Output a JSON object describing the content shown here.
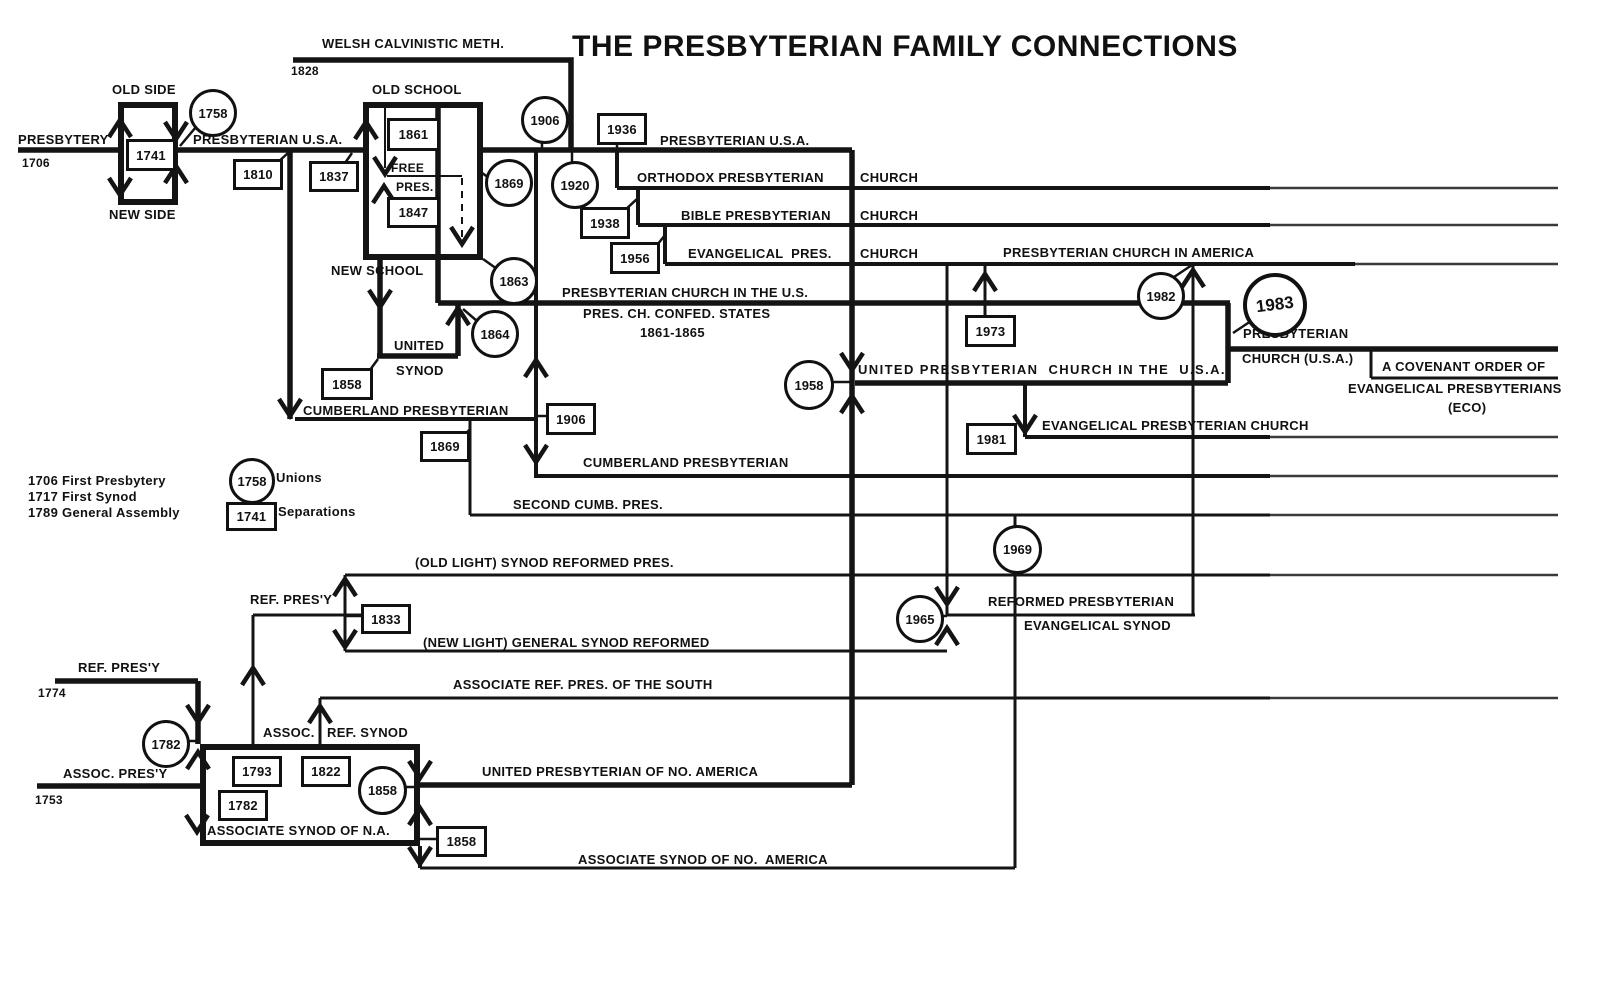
{
  "title": "THE PRESBYTERIAN FAMILY CONNECTIONS",
  "legend": {
    "line1": "1706 First Presbytery",
    "line2": "1717 First Synod",
    "line3": "1789 General Assembly",
    "unions_label": "Unions",
    "separations_label": "Separations"
  },
  "labels": {
    "presbytery": "PRESBYTERY",
    "y1706": "1706",
    "old_side": "OLD SIDE",
    "new_side": "NEW SIDE",
    "presbyterian_usa": "PRESBYTERIAN U.S.A.",
    "welsh": "WELSH CALVINISTIC METH.",
    "y1828": "1828",
    "old_school": "OLD SCHOOL",
    "free": "FREE",
    "pres": "PRES.",
    "new_school": "NEW SCHOOL",
    "united": "UNITED",
    "synod": "SYNOD",
    "orthodox": "ORTHODOX PRESBYTERIAN",
    "bible": "BIBLE PRESBYTERIAN",
    "evangelical_pres": "EVANGELICAL  PRES.",
    "church": "CHURCH",
    "pcus": "PRESBYTERIAN CHURCH IN THE U.S.",
    "confed": "PRES. CH. CONFED. STATES",
    "confed_years": "1861-1865",
    "cumberland": "CUMBERLAND PRESBYTERIAN",
    "second_cumb": "SECOND CUMB. PRES.",
    "pca": "PRESBYTERIAN CHURCH IN AMERICA",
    "upcusa": "UNITED PRESBYTERIAN  CHURCH IN THE  U.S.A.",
    "presbyterian": "PRESBYTERIAN",
    "church_usa": "CHURCH (U.S.A.)",
    "eco_line1": "A COVENANT ORDER OF",
    "eco_line2": "EVANGELICAL PRESBYTERIANS",
    "eco_line3": "(ECO)",
    "epc": "EVANGELICAL PRESBYTERIAN CHURCH",
    "old_light": "(OLD LIGHT) SYNOD REFORMED PRES.",
    "new_light": "(NEW LIGHT) GENERAL SYNOD REFORMED",
    "ref_presy": "REF. PRES'Y",
    "reformed_presbyterian": "REFORMED PRESBYTERIAN",
    "evangelical_synod": "EVANGELICAL SYNOD",
    "arp_south": "ASSOCIATE REF. PRES. OF THE SOUTH",
    "y1774": "1774",
    "y1753": "1753",
    "assoc_presy": "ASSOC. PRES'Y",
    "assoc": "ASSOC.",
    "ref_synod": "REF. SYNOD",
    "assoc_synod_na": "ASSOCIATE SYNOD OF N.A.",
    "upna": "UNITED PRESBYTERIAN OF NO. AMERICA",
    "assoc_synod_no_america": "ASSOCIATE SYNOD OF NO.  AMERICA"
  },
  "years": {
    "1741": "1741",
    "1758": "1758",
    "1782": "1782",
    "1793": "1793",
    "1810": "1810",
    "1822": "1822",
    "1828": "1828",
    "1833": "1833",
    "1837": "1837",
    "1847": "1847",
    "1858": "1858",
    "1861": "1861",
    "1863": "1863",
    "1864": "1864",
    "1869": "1869",
    "1906": "1906",
    "1920": "1920",
    "1936": "1936",
    "1938": "1938",
    "1956": "1956",
    "1958": "1958",
    "1965": "1965",
    "1969": "1969",
    "1973": "1973",
    "1981": "1981",
    "1982": "1982",
    "1983": "1983"
  }
}
